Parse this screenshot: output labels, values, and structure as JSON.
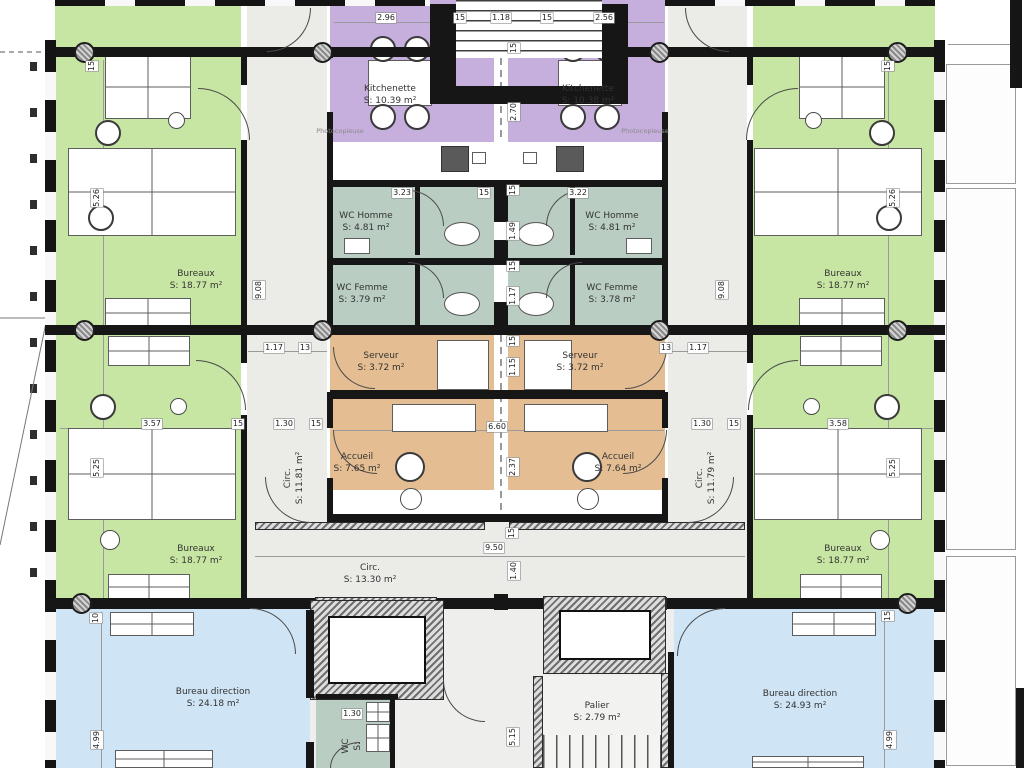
{
  "colors": {
    "office_green": "#c8e6a3",
    "kitchen_purple": "#c6aedd",
    "wc_teal": "#b9cdc2",
    "service_orange": "#e4bd92",
    "direction_blue": "#cfe4f4",
    "corridor_grey": "#ebebe8",
    "wall_black": "#161616"
  },
  "rooms": [
    {
      "id": "kitchenette-left",
      "name": "Kitchenette",
      "area": "S: 10.39 m²",
      "x": 390,
      "y": 95
    },
    {
      "id": "kitchenette-right",
      "name": "Kitchenette",
      "area": "S: 10.38 m²",
      "x": 588,
      "y": 95
    },
    {
      "id": "wc-homme-left",
      "name": "WC Homme",
      "area": "S: 4.81 m²",
      "x": 366,
      "y": 222
    },
    {
      "id": "wc-homme-right",
      "name": "WC Homme",
      "area": "S: 4.81 m²",
      "x": 612,
      "y": 222
    },
    {
      "id": "wc-femme-left",
      "name": "WC Femme",
      "area": "S: 3.79 m²",
      "x": 362,
      "y": 294
    },
    {
      "id": "wc-femme-right",
      "name": "WC Femme",
      "area": "S: 3.78 m²",
      "x": 612,
      "y": 294
    },
    {
      "id": "serveur-left",
      "name": "Serveur",
      "area": "S: 3.72 m²",
      "x": 381,
      "y": 362
    },
    {
      "id": "serveur-right",
      "name": "Serveur",
      "area": "S: 3.72 m²",
      "x": 580,
      "y": 362
    },
    {
      "id": "accueil-left",
      "name": "Accueil",
      "area": "S: 7.65 m²",
      "x": 357,
      "y": 463
    },
    {
      "id": "accueil-right",
      "name": "Accueil",
      "area": "S: 7.64 m²",
      "x": 618,
      "y": 463
    },
    {
      "id": "bureaux-upper-left",
      "name": "Bureaux",
      "area": "S: 18.77 m²",
      "x": 196,
      "y": 280
    },
    {
      "id": "bureaux-upper-right",
      "name": "Bureaux",
      "area": "S: 18.77 m²",
      "x": 843,
      "y": 280
    },
    {
      "id": "bureaux-lower-left",
      "name": "Bureaux",
      "area": "S: 18.77 m²",
      "x": 196,
      "y": 555
    },
    {
      "id": "bureaux-lower-right",
      "name": "Bureaux",
      "area": "S: 18.77 m²",
      "x": 843,
      "y": 555
    },
    {
      "id": "circ-left",
      "name": "Circ.",
      "area": "S: 11.81 m²",
      "x": 294,
      "y": 478,
      "vertical": true
    },
    {
      "id": "circ-right",
      "name": "Circ.",
      "area": "S: 11.79 m²",
      "x": 706,
      "y": 478,
      "vertical": true
    },
    {
      "id": "circ-bottom",
      "name": "Circ.",
      "area": "S: 13.30 m²",
      "x": 370,
      "y": 574
    },
    {
      "id": "bureau-direction-left",
      "name": "Bureau direction",
      "area": "S: 24.18 m²",
      "x": 213,
      "y": 698
    },
    {
      "id": "bureau-direction-right",
      "name": "Bureau direction",
      "area": "S: 24.93 m²",
      "x": 800,
      "y": 700
    },
    {
      "id": "palier",
      "name": "Palier",
      "area": "S: 2.79 m²",
      "x": 597,
      "y": 712
    },
    {
      "id": "wc-bottom",
      "name": "WC",
      "area": "S:",
      "x": 352,
      "y": 746,
      "vertical": true
    }
  ],
  "annotations": [
    {
      "text": "Photocopieuse",
      "x": 340,
      "y": 131
    },
    {
      "text": "Photocopieuse",
      "x": 645,
      "y": 131
    }
  ],
  "dimensions": [
    {
      "t": "2.96",
      "x": 386,
      "y": 18
    },
    {
      "t": "15",
      "x": 460,
      "y": 18
    },
    {
      "t": "1.18",
      "x": 501,
      "y": 18
    },
    {
      "t": "15",
      "x": 547,
      "y": 18
    },
    {
      "t": "2.56",
      "x": 604,
      "y": 18
    },
    {
      "t": "15",
      "x": 514,
      "y": 48,
      "v": true
    },
    {
      "t": "2.70",
      "x": 514,
      "y": 112,
      "v": true
    },
    {
      "t": "3.23",
      "x": 402,
      "y": 193
    },
    {
      "t": "15",
      "x": 484,
      "y": 193
    },
    {
      "t": "3.22",
      "x": 578,
      "y": 193
    },
    {
      "t": "15",
      "x": 513,
      "y": 190,
      "v": true
    },
    {
      "t": "1.49",
      "x": 513,
      "y": 231,
      "v": true
    },
    {
      "t": "15",
      "x": 513,
      "y": 266,
      "v": true
    },
    {
      "t": "1.17",
      "x": 513,
      "y": 296,
      "v": true
    },
    {
      "t": "15",
      "x": 513,
      "y": 341,
      "v": true
    },
    {
      "t": "1.15",
      "x": 513,
      "y": 367,
      "v": true
    },
    {
      "t": "1.17",
      "x": 274,
      "y": 348
    },
    {
      "t": "13",
      "x": 305,
      "y": 348
    },
    {
      "t": "13",
      "x": 666,
      "y": 348
    },
    {
      "t": "1.17",
      "x": 698,
      "y": 348
    },
    {
      "t": "3.57",
      "x": 152,
      "y": 424
    },
    {
      "t": "15",
      "x": 238,
      "y": 424
    },
    {
      "t": "1.30",
      "x": 284,
      "y": 424
    },
    {
      "t": "15",
      "x": 316,
      "y": 424
    },
    {
      "t": "1.30",
      "x": 702,
      "y": 424
    },
    {
      "t": "15",
      "x": 734,
      "y": 424
    },
    {
      "t": "3.58",
      "x": 838,
      "y": 424
    },
    {
      "t": "6.60",
      "x": 497,
      "y": 427
    },
    {
      "t": "2.37",
      "x": 513,
      "y": 467,
      "v": true
    },
    {
      "t": "9.08",
      "x": 259,
      "y": 290,
      "v": true
    },
    {
      "t": "9.08",
      "x": 722,
      "y": 290,
      "v": true
    },
    {
      "t": "15",
      "x": 92,
      "y": 66,
      "v": true
    },
    {
      "t": "15",
      "x": 888,
      "y": 66,
      "v": true
    },
    {
      "t": "5.26",
      "x": 97,
      "y": 198,
      "v": true
    },
    {
      "t": "5.26",
      "x": 893,
      "y": 198,
      "v": true
    },
    {
      "t": "5.25",
      "x": 97,
      "y": 468,
      "v": true
    },
    {
      "t": "5.25",
      "x": 893,
      "y": 468,
      "v": true
    },
    {
      "t": "9.50",
      "x": 494,
      "y": 548
    },
    {
      "t": "15",
      "x": 512,
      "y": 533,
      "v": true
    },
    {
      "t": "1.40",
      "x": 514,
      "y": 571,
      "v": true
    },
    {
      "t": "10",
      "x": 96,
      "y": 618,
      "v": true
    },
    {
      "t": "15",
      "x": 888,
      "y": 616,
      "v": true
    },
    {
      "t": "1.30",
      "x": 352,
      "y": 714
    },
    {
      "t": "5.15",
      "x": 513,
      "y": 737,
      "v": true
    },
    {
      "t": "4.99",
      "x": 97,
      "y": 740,
      "v": true
    },
    {
      "t": "4.99",
      "x": 890,
      "y": 740,
      "v": true
    }
  ]
}
